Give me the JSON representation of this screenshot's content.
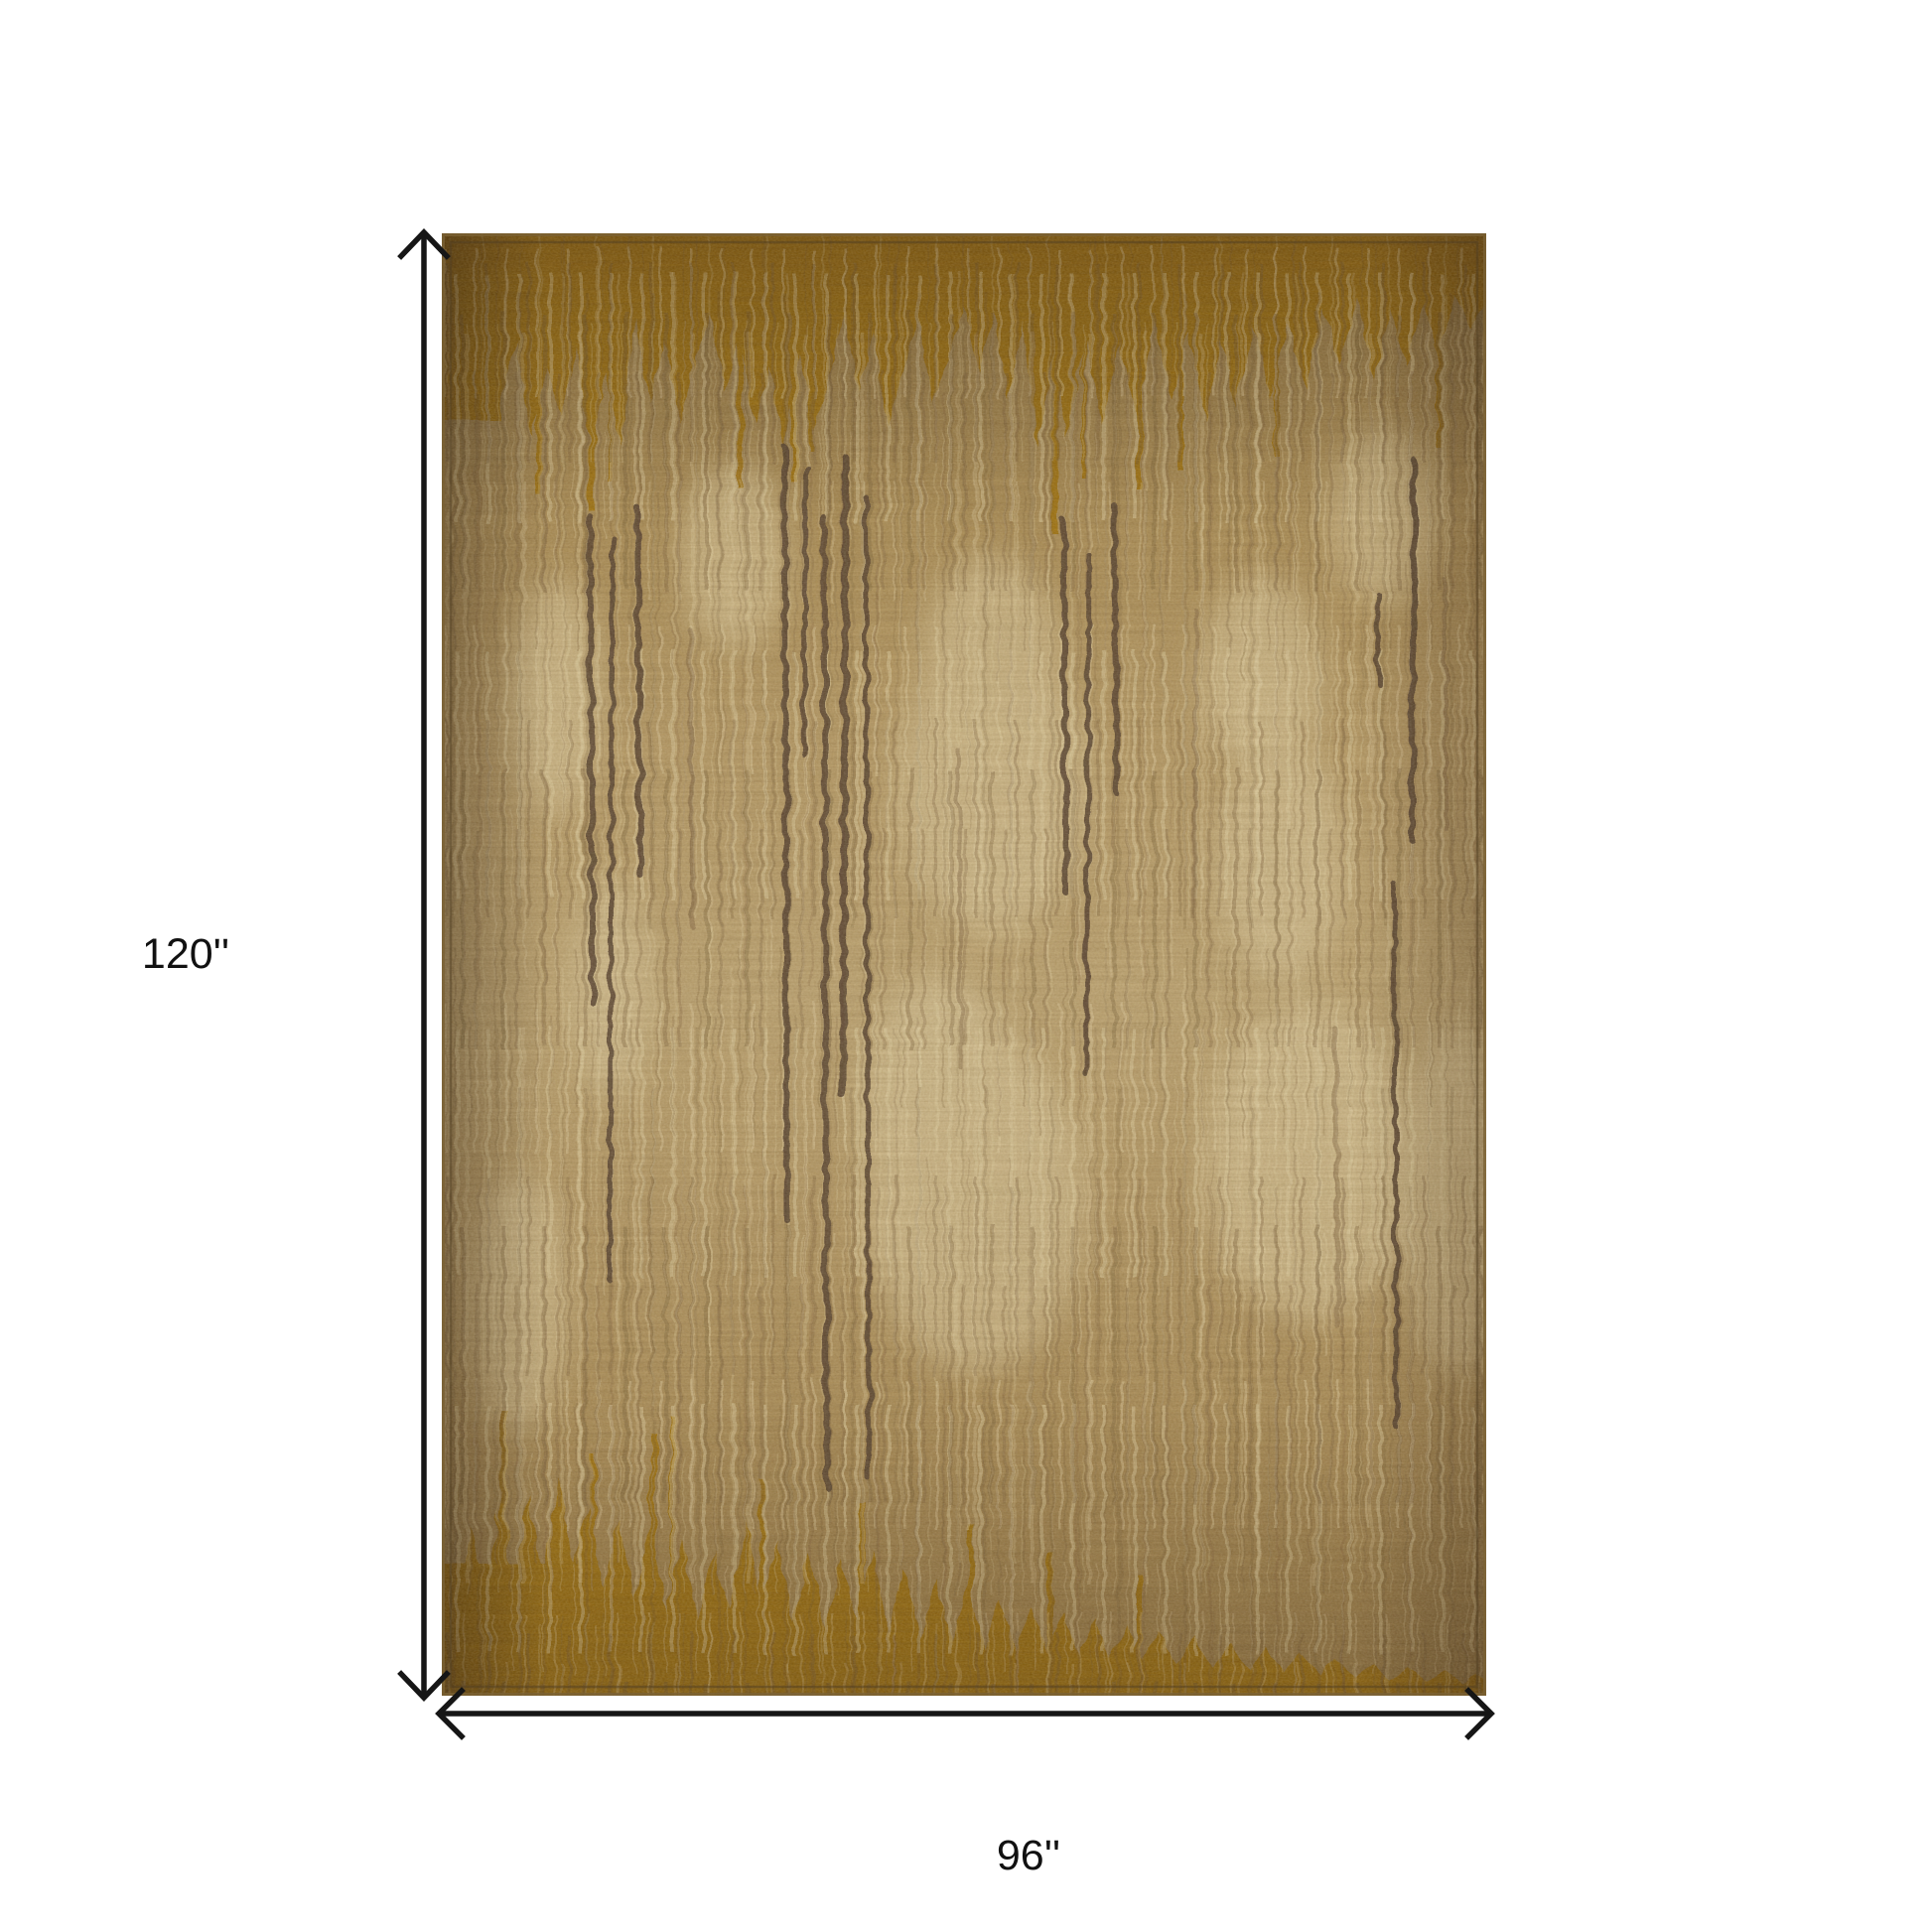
{
  "page": {
    "background": "#ffffff",
    "kind": "product-dimension-diagram"
  },
  "diagram": {
    "height_label": "120''",
    "width_label": "96''",
    "line_color": "#161616",
    "text_color": "#111111"
  },
  "rug": {
    "description": "Abstract ikat vertical-stripe area rug in gold, camel, tan and brown with mustard borders",
    "palette": {
      "base_tan": "#b3955f",
      "light_cream": "#e6d6aa",
      "medium_brown": "#7a5c3a",
      "dark_brown": "#5a4430",
      "mustard_gold": "#a87a12",
      "edge_shadow": "#4f3d22",
      "outer_edge": "#7a6134"
    }
  }
}
